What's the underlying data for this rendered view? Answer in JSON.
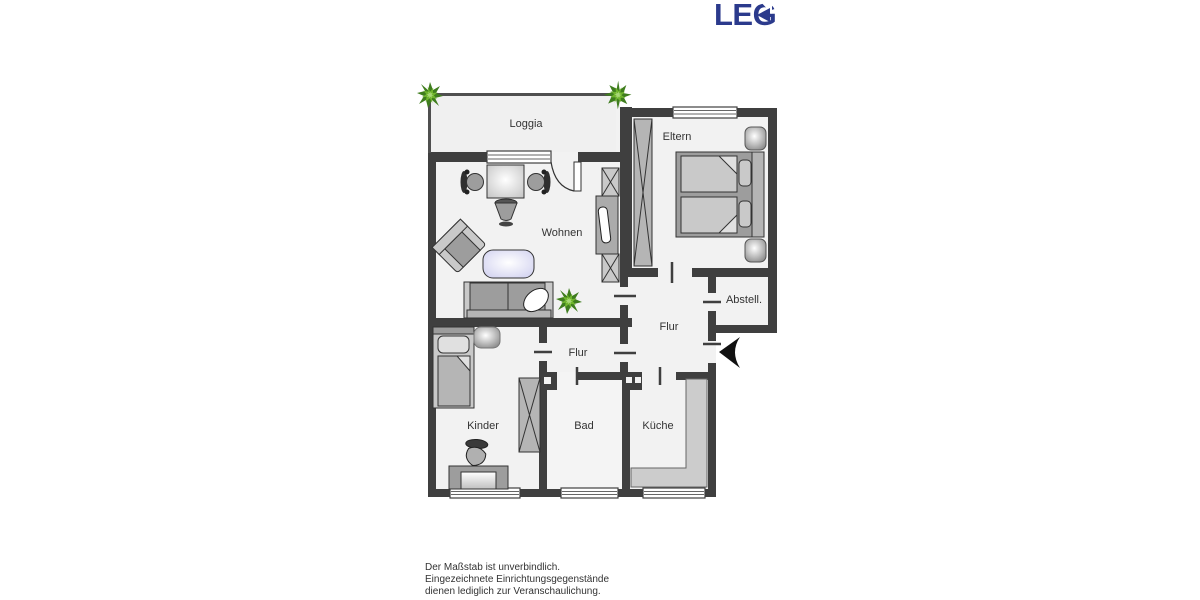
{
  "logo": {
    "text": "LEG"
  },
  "rooms": {
    "loggia": "Loggia",
    "wohnen": "Wohnen",
    "eltern": "Eltern",
    "abstell": "Abstell.",
    "flur_upper": "Flur",
    "flur_lower": "Flur",
    "kinder": "Kinder",
    "bad": "Bad",
    "kueche": "Küche"
  },
  "disclaimer": {
    "line1": "Der Maßstab ist unverbindlich.",
    "line2": "Eingezeichnete Einrichtungsgegenstände",
    "line3": "dienen lediglich zur Veranschaulichung."
  },
  "colors": {
    "logo_blue": "#2b3a8c",
    "wall": "#3f3f3f",
    "room_fill": "#f2f2f2",
    "plant_green": "#3f7d1e",
    "coffee_table": "#ccccee"
  }
}
